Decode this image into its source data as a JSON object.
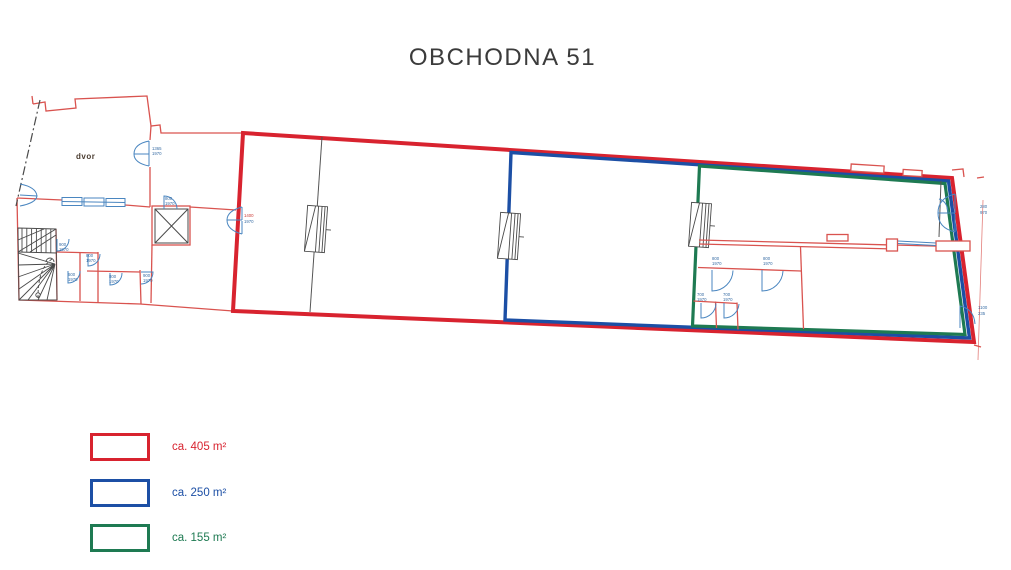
{
  "title": "OBCHODNA 51",
  "plan": {
    "courtyard_label": "dvor",
    "dimension_labels": [
      {
        "text": "1365",
        "x": 152,
        "y": 150
      },
      {
        "text": "1970",
        "x": 152,
        "y": 155
      },
      {
        "text": "800",
        "x": 165,
        "y": 200
      },
      {
        "text": "1970",
        "x": 165,
        "y": 205
      },
      {
        "text": "1400",
        "x": 244,
        "y": 217,
        "color": "#cc3b35"
      },
      {
        "text": "1970",
        "x": 244,
        "y": 223
      },
      {
        "text": "900",
        "x": 59,
        "y": 246
      },
      {
        "text": "1970",
        "x": 59,
        "y": 251
      },
      {
        "text": "800",
        "x": 86,
        "y": 257
      },
      {
        "text": "1970",
        "x": 86,
        "y": 262
      },
      {
        "text": "600",
        "x": 68,
        "y": 276
      },
      {
        "text": "1970",
        "x": 68,
        "y": 281
      },
      {
        "text": "800",
        "x": 109,
        "y": 278
      },
      {
        "text": "1970",
        "x": 109,
        "y": 283
      },
      {
        "text": "900",
        "x": 143,
        "y": 277
      },
      {
        "text": "1970",
        "x": 143,
        "y": 282
      },
      {
        "text": "800",
        "x": 712,
        "y": 260
      },
      {
        "text": "1970",
        "x": 712,
        "y": 265
      },
      {
        "text": "800",
        "x": 763,
        "y": 260
      },
      {
        "text": "1970",
        "x": 763,
        "y": 265
      },
      {
        "text": "700",
        "x": 697,
        "y": 296
      },
      {
        "text": "1970",
        "x": 697,
        "y": 301
      },
      {
        "text": "700",
        "x": 723,
        "y": 296
      },
      {
        "text": "1970",
        "x": 723,
        "y": 301
      },
      {
        "text": "280",
        "x": 980,
        "y": 208
      },
      {
        "text": "970",
        "x": 980,
        "y": 214
      },
      {
        "text": "1100",
        "x": 978,
        "y": 309
      },
      {
        "text": "235",
        "x": 978,
        "y": 315
      }
    ]
  },
  "legend": {
    "items": [
      {
        "label": "ca. 405 m²",
        "color": "#d8232f"
      },
      {
        "label": "ca. 250 m²",
        "color": "#1c4fa5"
      },
      {
        "label": "ca. 155 m²",
        "color": "#1e7a52"
      }
    ]
  },
  "colors": {
    "outline_red": "#d8232f",
    "outline_blue": "#1c4fa5",
    "outline_green": "#1e7a52",
    "wall_red": "#d9534f",
    "door_blue": "#4a86c0",
    "line_black": "#4a4a4a",
    "title_text": "#3b3b3b"
  }
}
